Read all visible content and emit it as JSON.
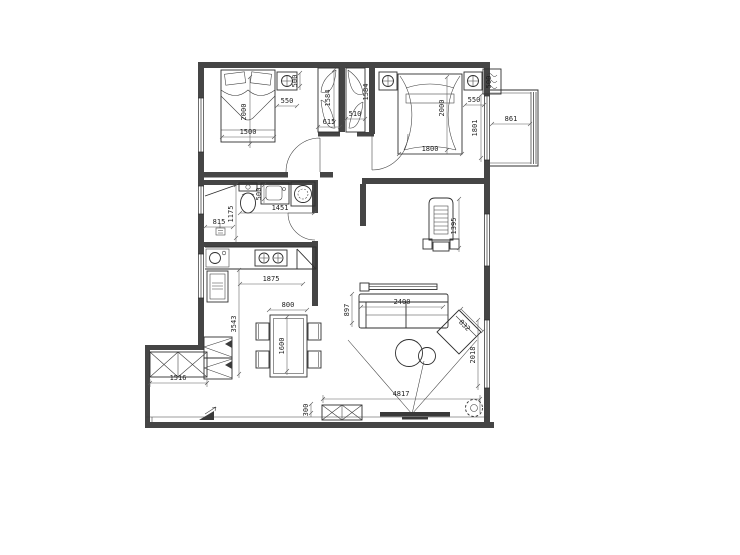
{
  "drawing": {
    "type": "apartment floor plan",
    "bg_color": "#ffffff",
    "wall_color": "#454545",
    "line_color": "#2f2f2f",
    "dim_color": "#1c1c1c"
  },
  "icons": [
    "washing-machine-icon",
    "water-heater-icon",
    "fan-symbol-icon",
    "floor-drain-icon",
    "entrance-arrow-icon",
    "nightstand-lamp-icon"
  ],
  "dims": {
    "bed1_len": "2000",
    "bed1_w": "1500",
    "ns1_w": "550",
    "ns1_d": "500",
    "ward1_d": "1584",
    "ward1_w": "615",
    "closet_w": "510",
    "closet_d": "1584",
    "bed2_len": "2000",
    "bed2_w": "1800",
    "ns2_w": "550",
    "ns2_d": "500",
    "balcony_w": "861",
    "balcony_len": "1801",
    "shower_w": "815",
    "bath_d": "1175",
    "basin_w": "500",
    "bath_w": "1451",
    "counter_w": "1875",
    "kitchen_len": "3543",
    "table_w": "800",
    "table_len": "1600",
    "piano_len": "1395",
    "sofa_d": "897",
    "sofa_w": "2400",
    "chaise_w": "832",
    "lr_window": "2018",
    "lr_w": "4817",
    "tv_off": "300",
    "shoe_cab_w": "1516"
  }
}
